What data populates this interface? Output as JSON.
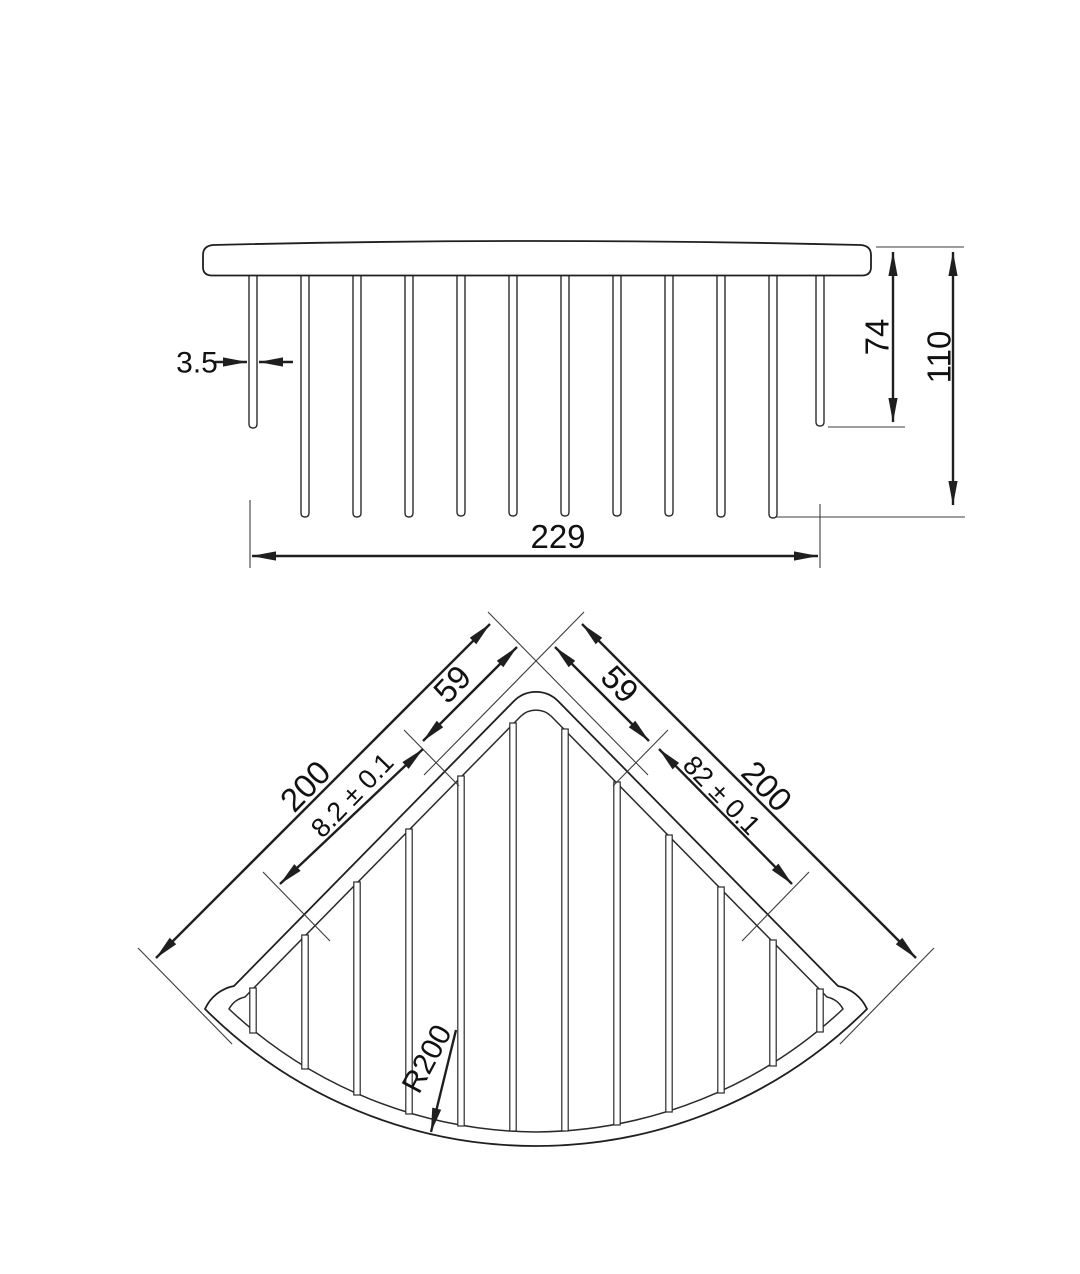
{
  "drawing": {
    "type": "technical-drawing",
    "subject": "corner wire basket",
    "colors": {
      "line": "#1f1f1f",
      "background": "#ffffff"
    },
    "side_view": {
      "wire_diameter": "3.5",
      "overall_width": "229",
      "end_wire_drop": "74",
      "overall_depth": "110",
      "wire_count": 12
    },
    "plan_view": {
      "left": {
        "edge_length": "200",
        "apex_offset": "59",
        "segment": "8.2 ± 0.1"
      },
      "right": {
        "edge_length": "200",
        "apex_offset": "59",
        "segment": "82 ± 0.1"
      },
      "arc_radius": "R200",
      "wire_count": 12
    }
  }
}
